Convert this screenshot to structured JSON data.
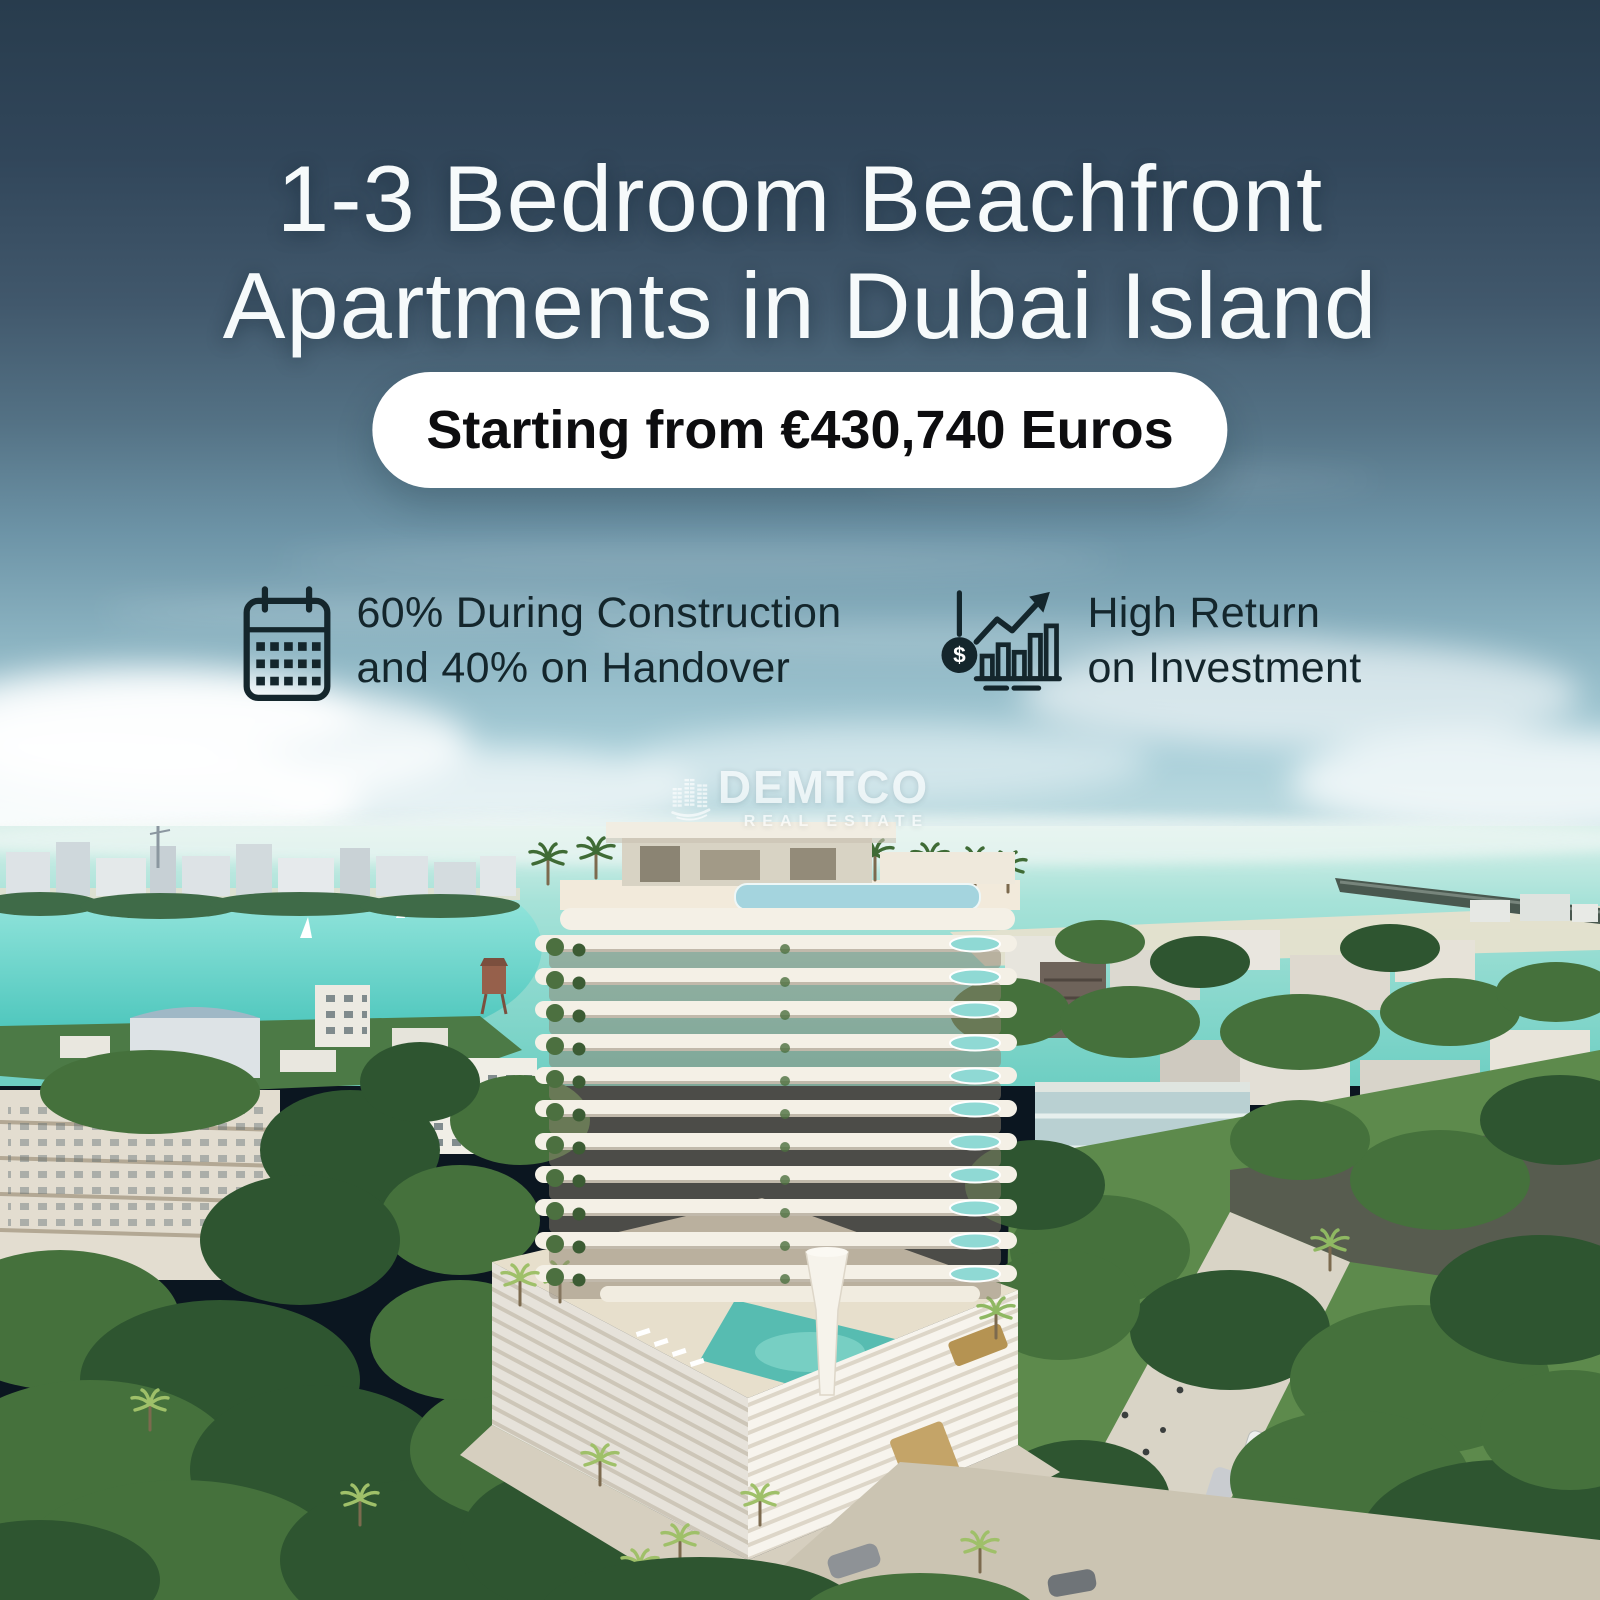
{
  "headline": {
    "line1": "1-3 Bedroom Beachfront",
    "line2": "Apartments in Dubai Island"
  },
  "price_badge": {
    "label": "Starting from €430,740 Euros"
  },
  "features": [
    {
      "icon": "calendar-icon",
      "line1": "60% During Construction",
      "line2": "and 40% on Handover"
    },
    {
      "icon": "roi-growth-chart-icon",
      "coin_symbol": "$",
      "line1": "High Return",
      "line2": "on Investment"
    }
  ],
  "watermark": {
    "icon": "buildings-leaf-icon",
    "brand": "DEMTCO",
    "tagline": "REAL ESTATE"
  },
  "colors": {
    "sky_top": "#283c4d",
    "sky_mid": "#5d8095",
    "sky_light": "#a9cfd9",
    "sea": "#7fd2c8",
    "lagoon": "#4cc8be",
    "tower_cream": "#f4f0e6",
    "pool_teal": "#5fbdb2",
    "headline_text": "#f6fafb",
    "badge_bg": "#ffffff",
    "badge_text": "#0d0d0f",
    "feature_text": "#14262c"
  }
}
